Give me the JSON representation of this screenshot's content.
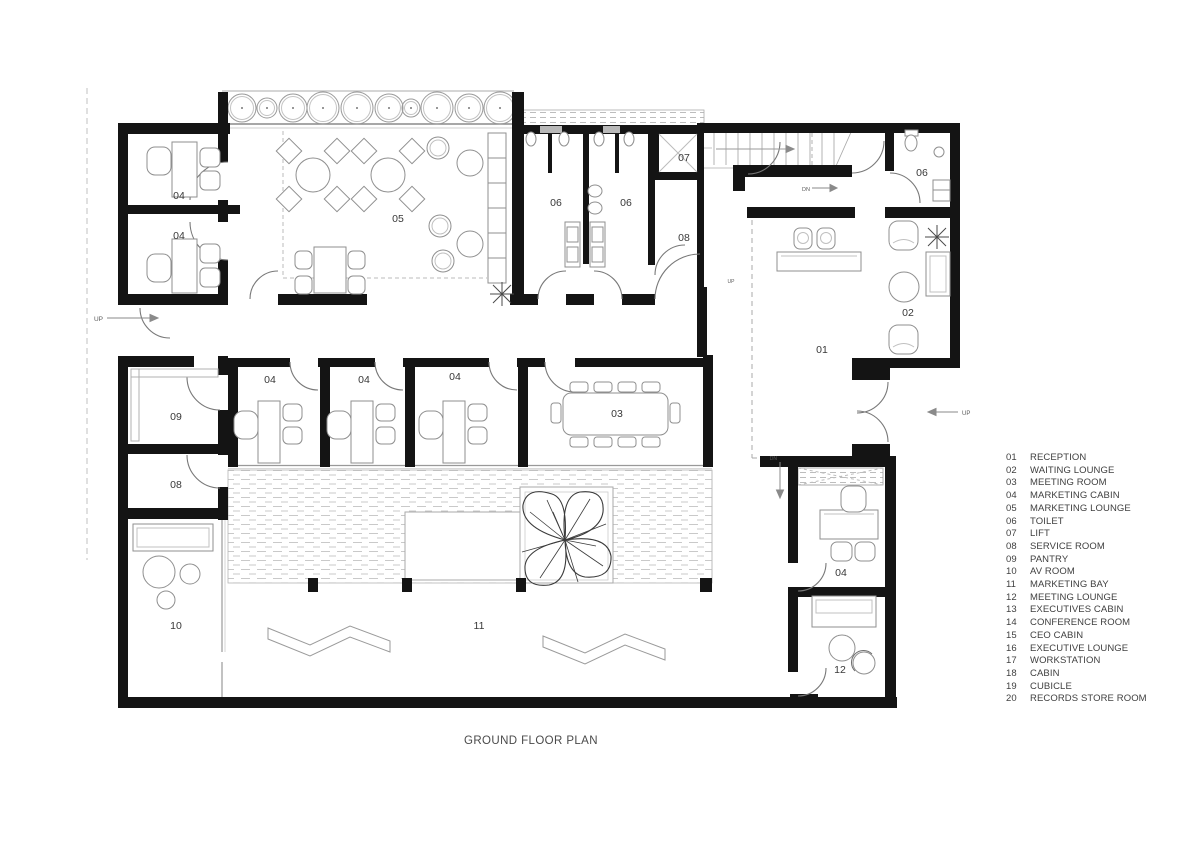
{
  "title": "GROUND FLOOR PLAN",
  "legend": {
    "items": [
      {
        "num": "01",
        "label": "RECEPTION"
      },
      {
        "num": "02",
        "label": "WAITING LOUNGE"
      },
      {
        "num": "03",
        "label": "MEETING ROOM"
      },
      {
        "num": "04",
        "label": "MARKETING CABIN"
      },
      {
        "num": "05",
        "label": "MARKETING LOUNGE"
      },
      {
        "num": "06",
        "label": "TOILET"
      },
      {
        "num": "07",
        "label": "LIFT"
      },
      {
        "num": "08",
        "label": "SERVICE ROOM"
      },
      {
        "num": "09",
        "label": "PANTRY"
      },
      {
        "num": "10",
        "label": "AV ROOM"
      },
      {
        "num": "11",
        "label": "MARKETING BAY"
      },
      {
        "num": "12",
        "label": "MEETING LOUNGE"
      },
      {
        "num": "13",
        "label": "EXECUTIVES CABIN"
      },
      {
        "num": "14",
        "label": "CONFERENCE ROOM"
      },
      {
        "num": "15",
        "label": "CEO CABIN"
      },
      {
        "num": "16",
        "label": "EXECUTIVE LOUNGE"
      },
      {
        "num": "17",
        "label": "WORKSTATION"
      },
      {
        "num": "18",
        "label": "CABIN"
      },
      {
        "num": "19",
        "label": "CUBICLE"
      },
      {
        "num": "20",
        "label": "RECORDS STORE ROOM"
      }
    ]
  },
  "plan": {
    "room_labels": [
      {
        "text": "04"
      },
      {
        "text": "04"
      },
      {
        "text": "05"
      },
      {
        "text": "06"
      },
      {
        "text": "06"
      },
      {
        "text": "07"
      },
      {
        "text": "08"
      },
      {
        "text": "06"
      },
      {
        "text": "01"
      },
      {
        "text": "02"
      },
      {
        "text": "09"
      },
      {
        "text": "04"
      },
      {
        "text": "04"
      },
      {
        "text": "04"
      },
      {
        "text": "03"
      },
      {
        "text": "08"
      },
      {
        "text": "10"
      },
      {
        "text": "11"
      },
      {
        "text": "04"
      },
      {
        "text": "12"
      }
    ],
    "direction_labels": {
      "up_left": "UP",
      "stair_dn": "DN",
      "entry_up": "UP",
      "court_dn": "DN",
      "mid_up": "UP"
    }
  },
  "colors": {
    "wall": "#141414",
    "furniture": "#8f8f8f",
    "label": "#383838",
    "hatch": "#c6c6c6"
  }
}
